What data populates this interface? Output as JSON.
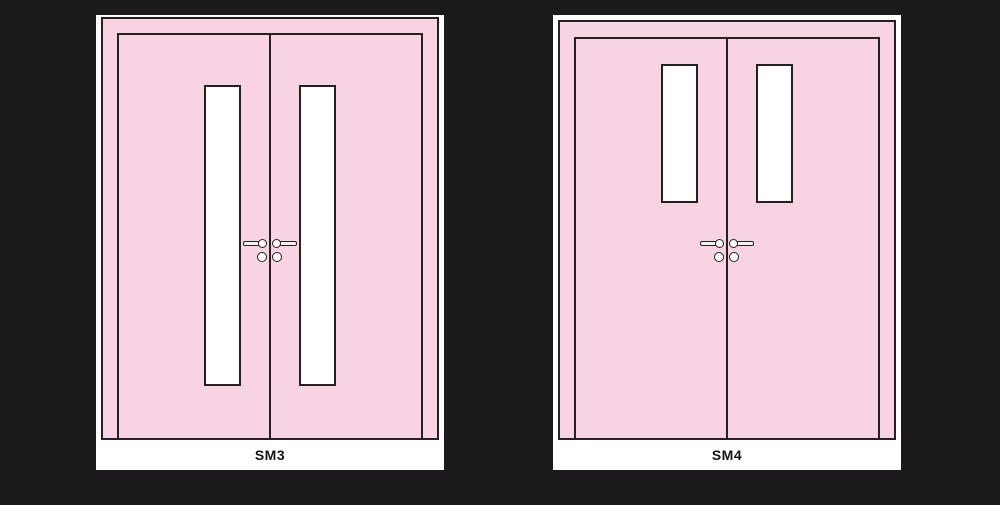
{
  "colors": {
    "bg": "#1b191b",
    "line": "#262023",
    "door": "#f8d3e3",
    "panel": "#ffffff",
    "hardware": "#f2f2f2",
    "text": "#141414"
  },
  "doors": [
    {
      "label": "SM3",
      "type": "double-leaf door elevation",
      "vision_panels": "two full-height narrow panels flanking the meeting stile",
      "hardware": "paired lever handles with roses and cylinders at meeting stile"
    },
    {
      "label": "SM4",
      "type": "double-leaf door elevation",
      "vision_panels": "two half-height narrow panels in upper portion",
      "hardware": "paired lever handles with roses and cylinders at meeting stile"
    }
  ]
}
